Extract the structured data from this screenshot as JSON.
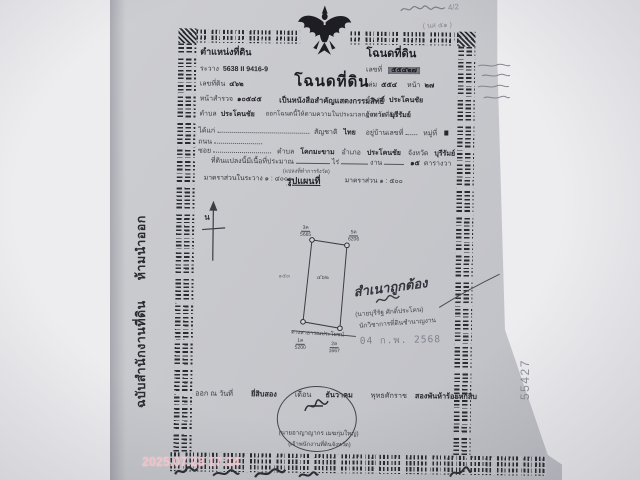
{
  "photo": {
    "camera_timestamp": "2025.07.23 17:14",
    "side_serial": "55427",
    "stub_vertical_text": "ฉบับสำนักงานที่ดิน  ห้ามนำออก",
    "pencil_note_fraction": "4/2",
    "pencil_note_2": "( นส ๕๑ )"
  },
  "left_box": {
    "header": "ตำแหน่งที่ดิน",
    "rawang_label": "ระวาง",
    "rawang_value": "5638 II 9416-9",
    "land_no_label": "เลขที่ดิน",
    "land_no_value": "๔๖๒",
    "survey_label": "หน้าสำรวจ",
    "survey_value": "๑๐๕๔๕",
    "tambon_label": "ตำบล",
    "tambon_value": "ประโคนชัย"
  },
  "right_box": {
    "header": "โฉนดที่ดิน",
    "no_label": "เลขที่",
    "no_value": "๕๕๔๒๗",
    "book_label": "เล่ม",
    "book_value": "๕๕๔",
    "page_label": "หน้า",
    "page_value": "๒๗",
    "amphoe_label": "อำเภอ",
    "amphoe_value": "ประโคนชัย",
    "province_label": "จังหวัด",
    "province_value": "บุรีรัมย์"
  },
  "title": {
    "main": "โฉนดที่ดิน",
    "subtitle": "เป็นหนังสือสำคัญแสดงกรรมสิทธิ์",
    "authority": "ออกโฉนดนี้ให้ตามความในประมวลกฎหมายที่ดิน"
  },
  "owner": {
    "daikae_label": "ได้แก่",
    "nationality_label": "สัญชาติ",
    "nationality_value": "ไทย",
    "house_label": "อยู่บ้านเลขที่",
    "moo_label": "หมู่ที่",
    "road_label": "ถนน",
    "soi_label": "ซอย",
    "tambon_label": "ตำบล",
    "tambon_value": "โคกมะขาม",
    "amphoe_label": "อำเภอ",
    "amphoe_value": "ประโคนชัย",
    "province_label": "จังหวัด",
    "province_value": "บุรีรัมย์",
    "area_label": "ที่ดินแปลงนี้มีเนื้อที่ประมาณ",
    "rai_label": "ไร่",
    "ngan_label": "งาน",
    "wa_value": "๑๕",
    "wa_label": "ตารางวา"
  },
  "map": {
    "scale_in_rawang": "มาตราส่วนในระวาง ๑ : ๔๐๐๐",
    "plot_note": "(แปลงที่ทำการรังวัด)",
    "map_heading": "รูปแผนที่",
    "scale_right": "มาตราส่วน ๑ : ๕๐๐",
    "north_label": "น",
    "parcel_no": "๔๖๒",
    "adjacent_no": "๑๕๓",
    "road_label": "ทางสาธารณประโยชน์",
    "corners": [
      {
        "id": "3ค",
        "num": "5665"
      },
      {
        "id": "5ค",
        "num": "6206"
      },
      {
        "id": "1ค",
        "num": "5200"
      },
      {
        "id": "2ค",
        "num": "1667"
      }
    ]
  },
  "certification": {
    "text": "สำเนาถูกต้อง",
    "name": "(นายบุรีรัฐ ศักดิ์ประโคน)",
    "role": "นักวิชาการที่ดินชำนาญงาน",
    "date_stamp": "04 ก.พ. 2568"
  },
  "issue": {
    "prefix": "ออก ณ วันที่",
    "day": "ยี่สิบสอง",
    "month_label": "เดือน",
    "month": "ธันวาคม",
    "era_label": "พุทธศักราช",
    "year": "สองพันห้าร้อยหกสิบ",
    "officer_name": "(นายอาญาญากร เมฆกุ่มใหญ่)",
    "officer_role": "(เจ้าพนักงานที่ดินจังหวัด)"
  }
}
